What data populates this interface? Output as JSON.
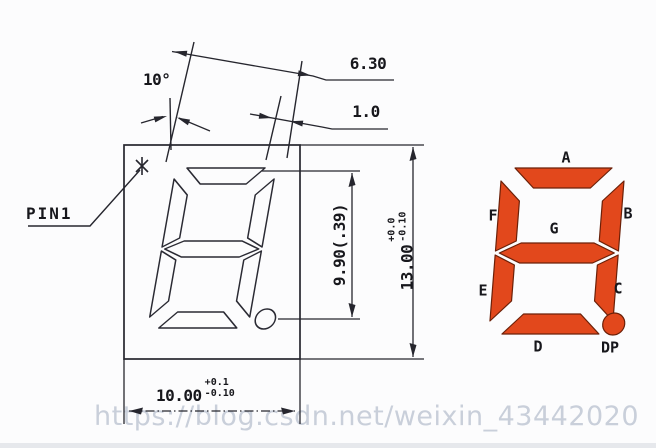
{
  "watermark": "https://blog.csdn.net/weixin_43442020",
  "drawing": {
    "pin1_label": "PIN1",
    "angle_label": "10°",
    "dim_segment_gap": "6.30",
    "dim_segment_width": "1.0",
    "dim_digit_height": "9.90(.39)",
    "dim_pkg_height": {
      "value": "13.00",
      "tol_plus": "+0.0",
      "tol_minus": "-0.10"
    },
    "dim_pkg_width": {
      "value": "10.00",
      "tol_plus": "+0.1",
      "tol_minus": "-0.10"
    }
  },
  "segment_diagram": {
    "labels": {
      "a": "A",
      "b": "B",
      "c": "C",
      "d": "D",
      "e": "E",
      "f": "F",
      "g": "G",
      "dp": "DP"
    },
    "segment_color": "#e2481c",
    "segment_outline_color": "#6b2008"
  },
  "colors": {
    "line": "#26262e",
    "watermark_text": "#c9cfda",
    "background": "#fcfcfd"
  }
}
